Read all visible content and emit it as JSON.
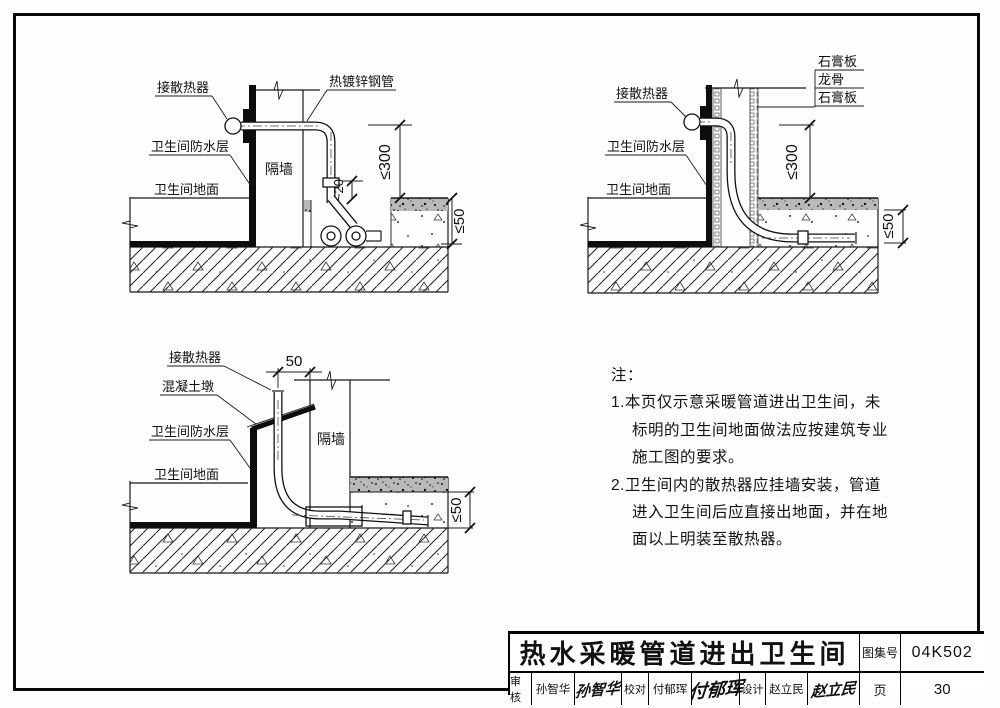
{
  "d1": {
    "labels": {
      "radiator": "接散热器",
      "pipe": "热镀锌钢管",
      "waterproof": "卫生间防水层",
      "floor": "卫生间地面",
      "wall": "隔墙"
    },
    "dims": {
      "height": "≤300",
      "stub": "~20",
      "cover": "≤50"
    }
  },
  "d2": {
    "labels": {
      "gypsum1": "石膏板",
      "keel": "龙骨",
      "gypsum2": "石膏板",
      "radiator": "接散热器",
      "waterproof": "卫生间防水层",
      "floor": "卫生间地面"
    },
    "dims": {
      "height": "≤300",
      "cover": "≤50"
    }
  },
  "d3": {
    "labels": {
      "radiator": "接散热器",
      "pier": "混凝土墩",
      "waterproof": "卫生间防水层",
      "floor": "卫生间地面",
      "wall": "隔墙"
    },
    "dims": {
      "offset": "50",
      "cover": "≤50"
    }
  },
  "notes": {
    "heading": "注：",
    "lines": [
      "1.本页仅示意采暖管道进出卫生间，未",
      "标明的卫生间地面做法应按建筑专业",
      "施工图的要求。",
      "2.卫生间内的散热器应挂墙安装，管道",
      "进入卫生间后应直接出地面，并在地",
      "面以上明装至散热器。"
    ]
  },
  "tb": {
    "title": "热水采暖管道进出卫生间",
    "atlas_label": "图集号",
    "atlas_no": "04K502",
    "page_label": "页",
    "page_no": "30",
    "cols": [
      {
        "label": "审核",
        "name": "孙智华",
        "sig": "孙智华"
      },
      {
        "label": "校对",
        "name": "付郁珲",
        "sig": "付郁珲"
      },
      {
        "label": "设计",
        "name": "赵立民",
        "sig": "赵立民"
      }
    ]
  }
}
